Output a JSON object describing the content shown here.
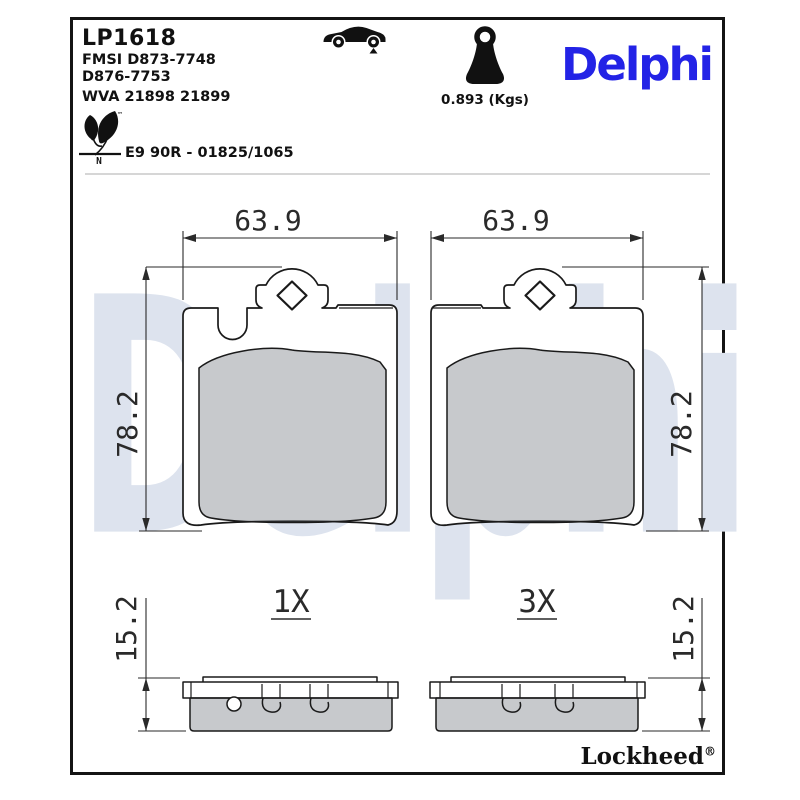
{
  "header": {
    "part_number": "LP1618",
    "fmsi": [
      "FMSI D873-7748",
      "D876-7753"
    ],
    "wva": "WVA 21898 21899",
    "weight": "0.893 (Kgs)",
    "brand": "Delphi",
    "homologation": "E9 90R - 01825/1065",
    "eco_mark_letter": "N",
    "trademark": "™"
  },
  "drawing": {
    "pad_width": "63.9",
    "pad_height": "78.2",
    "pad_thickness": "15.2",
    "left_quantity": "1X",
    "right_quantity": "3X"
  },
  "footer": {
    "brand": "Lockheed",
    "registered": "®"
  },
  "watermark": "Delphi",
  "colors": {
    "brand_blue": "#2323E6",
    "watermark_blue": "#DDE3EE",
    "drawing_line": "#1A1A1A",
    "friction_gray": "#C9CBCE"
  },
  "icons": {
    "car": "car-silhouette-icon",
    "axle_marker": "rear-axle-marker-icon",
    "weight": "weight-icon",
    "eco_leaf": "leaf-eco-icon"
  }
}
